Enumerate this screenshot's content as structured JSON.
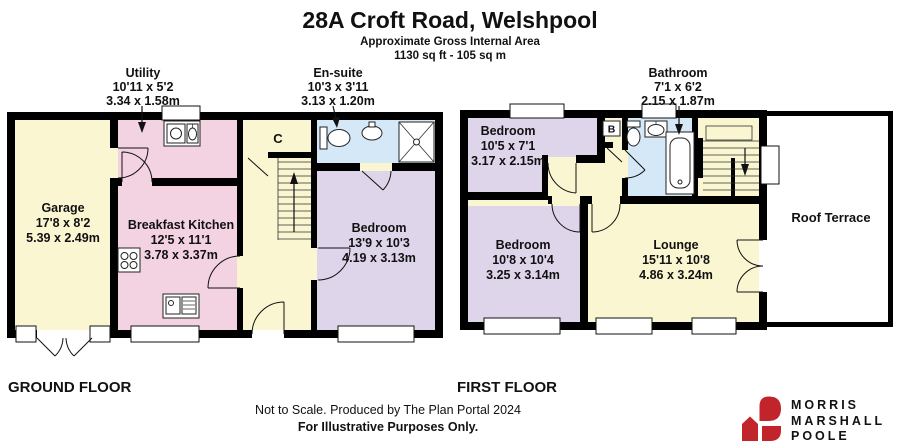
{
  "header": {
    "title": "28A Croft Road, Welshpool",
    "subtitle": "Approximate Gross Internal Area",
    "area": "1130 sq ft - 105 sq m"
  },
  "ground_floor": {
    "label": "GROUND FLOOR",
    "rooms": {
      "garage": {
        "name": "Garage",
        "imperial": "17'8 x 8'2",
        "metric": "5.39 x 2.49m"
      },
      "utility": {
        "name": "Utility",
        "imperial": "10'11 x 5'2",
        "metric": "3.34 x 1.58m"
      },
      "breakfast_kitchen": {
        "name": "Breakfast Kitchen",
        "imperial": "12'5 x 11'1",
        "metric": "3.78 x 3.37m"
      },
      "ensuite": {
        "name": "En-suite",
        "imperial": "10'3 x 3'11",
        "metric": "3.13 x 1.20m"
      },
      "bedroom": {
        "name": "Bedroom",
        "imperial": "13'9 x 10'3",
        "metric": "4.19 x 3.13m"
      },
      "cupboard": {
        "name": "C"
      }
    }
  },
  "first_floor": {
    "label": "FIRST FLOOR",
    "rooms": {
      "bedroom_front": {
        "name": "Bedroom",
        "imperial": "10'5 x 7'1",
        "metric": "3.17 x 2.15m"
      },
      "bathroom": {
        "name": "Bathroom",
        "imperial": "7'1 x 6'2",
        "metric": "2.15 x 1.87m"
      },
      "bedroom_rear": {
        "name": "Bedroom",
        "imperial": "10'8 x 10'4",
        "metric": "3.25 x 3.14m"
      },
      "lounge": {
        "name": "Lounge",
        "imperial": "15'11 x 10'8",
        "metric": "4.86 x 3.24m"
      },
      "roof_terrace": {
        "name": "Roof Terrace"
      },
      "boiler": {
        "name": "B"
      }
    }
  },
  "footer": {
    "line1": "Not to Scale. Produced by The Plan Portal 2024",
    "line2": "For Illustrative Purposes Only."
  },
  "logo": {
    "line1": "MORRIS",
    "line2": "MARSHALL",
    "line3": "POOLE"
  },
  "colors": {
    "room_yellow": "#FAF6D2",
    "room_pink": "#F3D2E2",
    "room_purple": "#DFD5EB",
    "room_blue": "#D4E8F7",
    "wall": "#000000",
    "logo_red": "#C2242C"
  }
}
